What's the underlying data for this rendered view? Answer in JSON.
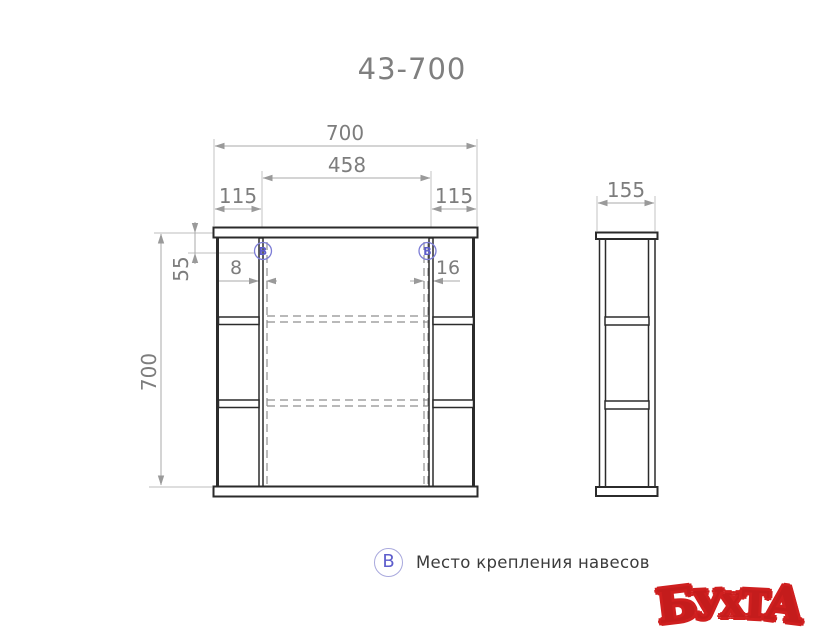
{
  "title": "43-700",
  "views": {
    "front": {
      "width_label": "700",
      "mirror_width_label": "458",
      "left_offset_label": "115",
      "right_offset_label": "115",
      "height_label": "700",
      "mount_top_offset_label": "55",
      "mount_left_gap_label": "8",
      "mount_right_gap_label": "16"
    },
    "side": {
      "depth_label": "155"
    }
  },
  "markers": {
    "mount_point": "B"
  },
  "legend": {
    "symbol": "B",
    "label": "Место крепления навесов"
  },
  "logo": {
    "text": "БУХТА",
    "color": "#c41c1c"
  },
  "colors": {
    "outline": "#2b2b2b",
    "dimension_line": "#a9a9a9",
    "dimension_text": "#7d7d7d",
    "hidden_line": "#8f8f8f",
    "marker_blue": "#5d5dcc",
    "title_text": "#7f7f7f",
    "legend_text": "#3b3b3b"
  }
}
